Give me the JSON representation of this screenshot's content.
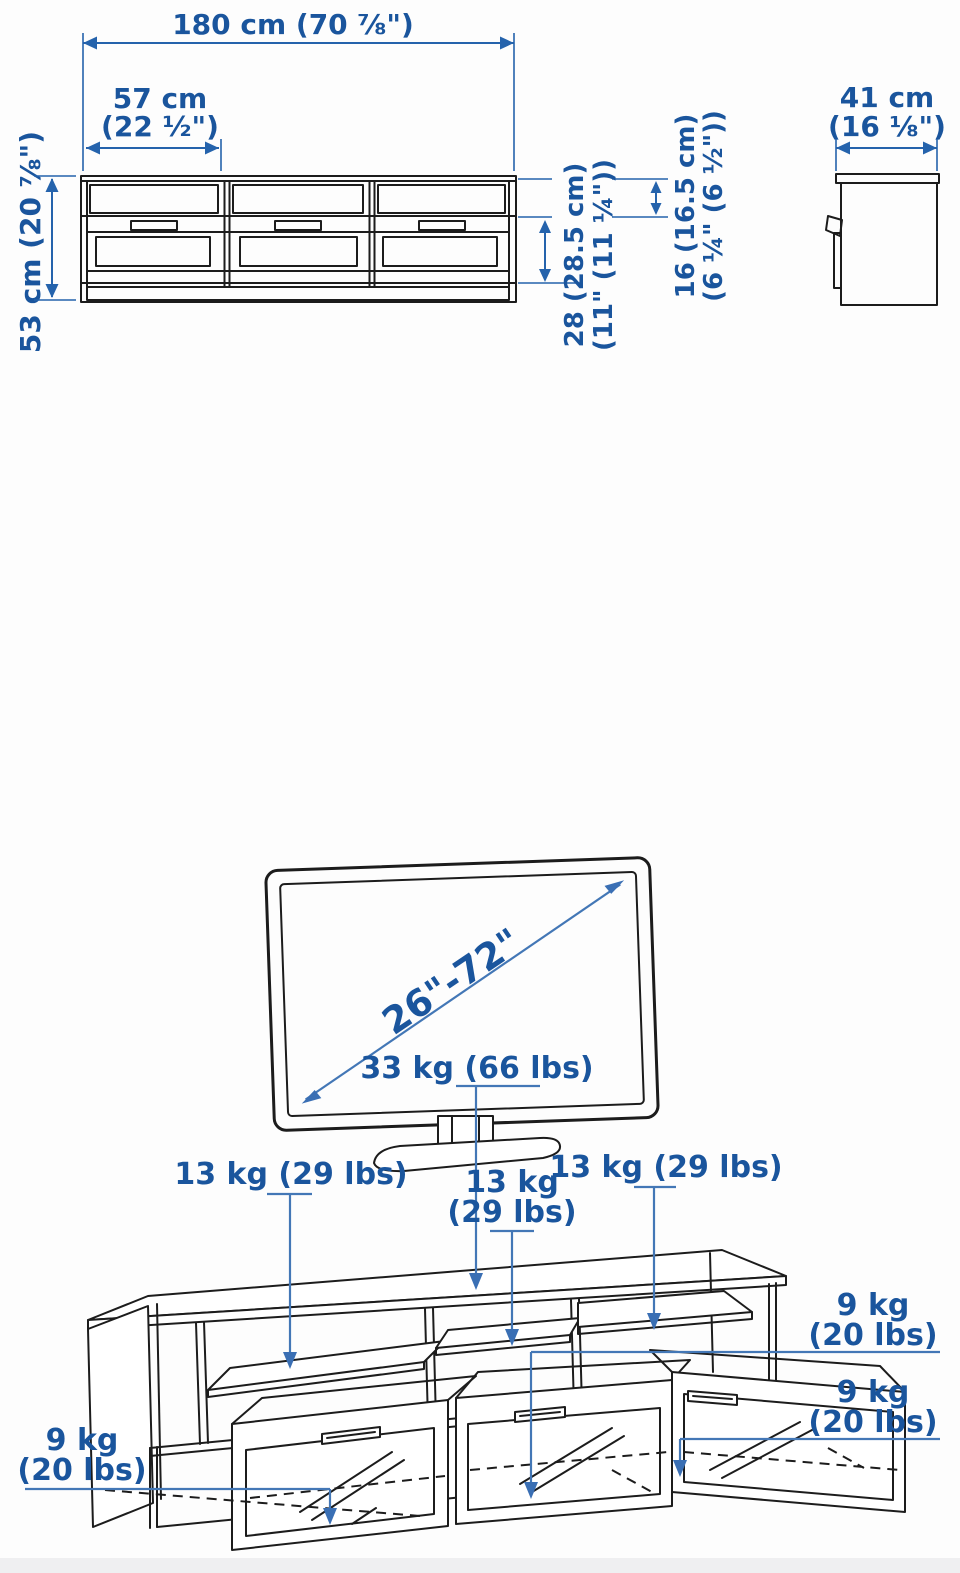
{
  "colors": {
    "dimension_blue": "#1a559d",
    "leader_blue": "#4377b6",
    "line_black": "#1c1c1c",
    "footer_gray": "#efeff1"
  },
  "front_view": {
    "overall_width": "180 cm (70 ⅞\")",
    "section_width_line1": "57 cm",
    "section_width_line2": "(22 ½\")",
    "overall_height": "53 cm (20 ⅞\")",
    "drawer_height_line1": "28 (28.5 cm)",
    "drawer_height_line2": "(11\" (11 ¼\"))",
    "shelf_opening_height_line1": "16 (16.5 cm)",
    "shelf_opening_height_line2": "(6 ¼\" (6 ½\"))"
  },
  "side_view": {
    "depth_line1": "41 cm",
    "depth_line2": "(16 ⅛\")"
  },
  "tv": {
    "screen_size_range": "26\"-72\""
  },
  "loads": {
    "top_panel": "33 kg (66 lbs)",
    "shelf_left": "13 kg (29 lbs)",
    "shelf_middle_line1": "13 kg",
    "shelf_middle_line2": "(29 lbs)",
    "shelf_right": "13 kg (29 lbs)",
    "drawer_right_top_line1": "9 kg",
    "drawer_right_top_line2": "(20 lbs)",
    "drawer_right_bottom_line1": "9 kg",
    "drawer_right_bottom_line2": "(20 lbs)",
    "drawer_left_line1": "9 kg",
    "drawer_left_line2": "(20 lbs)"
  }
}
